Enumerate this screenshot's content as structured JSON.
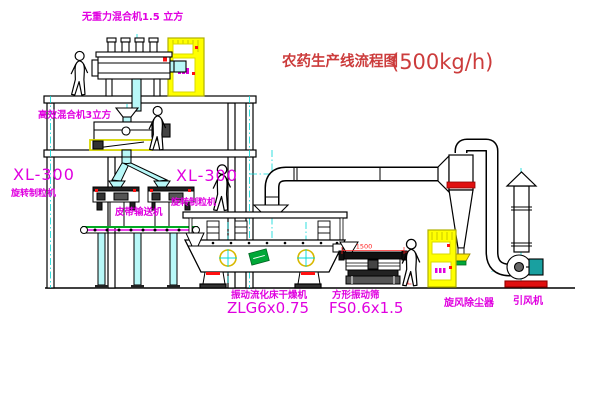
{
  "title": {
    "name": "农药生产线流程图",
    "capacity": "(500kg/h)"
  },
  "equipment": {
    "gravity_mixer": {
      "label": "无重力混合机1.5 立方"
    },
    "wet_mixer": {
      "label": "高效混合机3立方"
    },
    "granulator_left": {
      "model": "XL-300",
      "label": "旋转制粒机"
    },
    "granulator_mid": {
      "model": "XL-300",
      "label": "旋转制粒机"
    },
    "belt_conveyor": {
      "label": "皮带输送机"
    },
    "dryer": {
      "label": "振动流化床干燥机",
      "model": "ZLG6x0.75"
    },
    "sieve": {
      "label": "方形振动筛",
      "model": "FS0.6x1.5",
      "dim_width": "1500",
      "dim_height": "541"
    },
    "cyclone": {
      "label": "旋风除尘器"
    },
    "fan": {
      "label": "引风机"
    }
  },
  "colors": {
    "label_magenta": "#e000e0",
    "title_red": "#cc3c3c",
    "accent_red": "#ff1010",
    "cabinet_yellow": "#ffff00",
    "pipe_cyan": "#00d8d8",
    "logo_green": "#00a838"
  }
}
